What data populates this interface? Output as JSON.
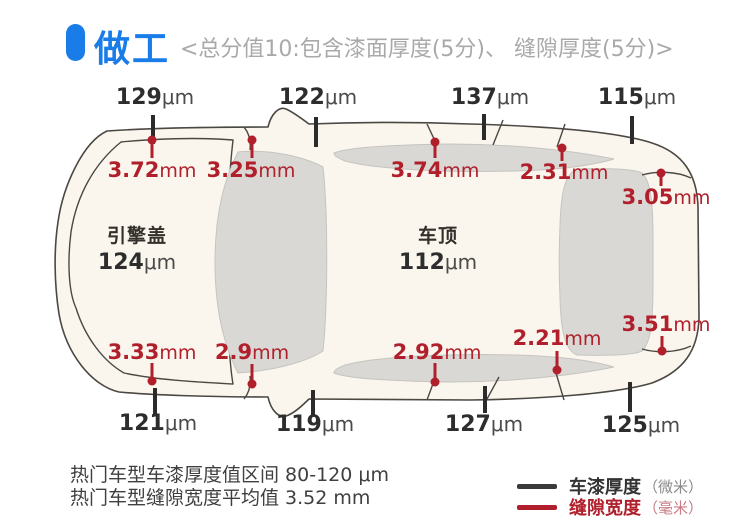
{
  "header": {
    "title": "做工",
    "subtitle": "<总分值10:包含漆面厚度(5分)、 缝隙厚度(5分)>"
  },
  "colors": {
    "accent_blue": "#1a7ce8",
    "paint_black": "#2b2b2b",
    "gap_red": "#b01f2b",
    "car_body_fill": "#faf6ed",
    "glass_fill": "#d9d8d5",
    "outline": "#4b4843"
  },
  "diagram": {
    "type": "car-top-view-measurements",
    "paint_points": [
      {
        "position": "top-1",
        "value": "129",
        "unit": "μm"
      },
      {
        "position": "top-2",
        "value": "122",
        "unit": "μm"
      },
      {
        "position": "top-3",
        "value": "137",
        "unit": "μm"
      },
      {
        "position": "top-4",
        "value": "115",
        "unit": "μm"
      },
      {
        "position": "bottom-1",
        "value": "121",
        "unit": "μm"
      },
      {
        "position": "bottom-2",
        "value": "119",
        "unit": "μm"
      },
      {
        "position": "bottom-3",
        "value": "127",
        "unit": "μm"
      },
      {
        "position": "bottom-4",
        "value": "125",
        "unit": "μm"
      }
    ],
    "gap_points": [
      {
        "position": "top-1",
        "value": "3.72",
        "unit": "mm"
      },
      {
        "position": "top-2",
        "value": "3.25",
        "unit": "mm"
      },
      {
        "position": "top-3",
        "value": "3.74",
        "unit": "mm"
      },
      {
        "position": "top-4",
        "value": "2.31",
        "unit": "mm"
      },
      {
        "position": "top-5",
        "value": "3.05",
        "unit": "mm"
      },
      {
        "position": "bottom-1",
        "value": "3.33",
        "unit": "mm"
      },
      {
        "position": "bottom-2",
        "value": "2.9",
        "unit": "mm"
      },
      {
        "position": "bottom-3",
        "value": "2.92",
        "unit": "mm"
      },
      {
        "position": "bottom-4",
        "value": "2.21",
        "unit": "mm"
      },
      {
        "position": "bottom-5",
        "value": "3.51",
        "unit": "mm"
      }
    ],
    "panels": [
      {
        "name": "引擎盖",
        "value": "124",
        "unit": "μm"
      },
      {
        "name": "车顶",
        "value": "112",
        "unit": "μm"
      }
    ]
  },
  "footnotes": {
    "line1": "热门车型车漆厚度值区间 80-120 μm",
    "line2": "热门车型缝隙宽度平均值 3.52 mm"
  },
  "legend": {
    "paint": {
      "label": "车漆厚度",
      "unit": "（微米）"
    },
    "gap": {
      "label": "缝隙宽度",
      "unit": "（毫米）"
    }
  }
}
